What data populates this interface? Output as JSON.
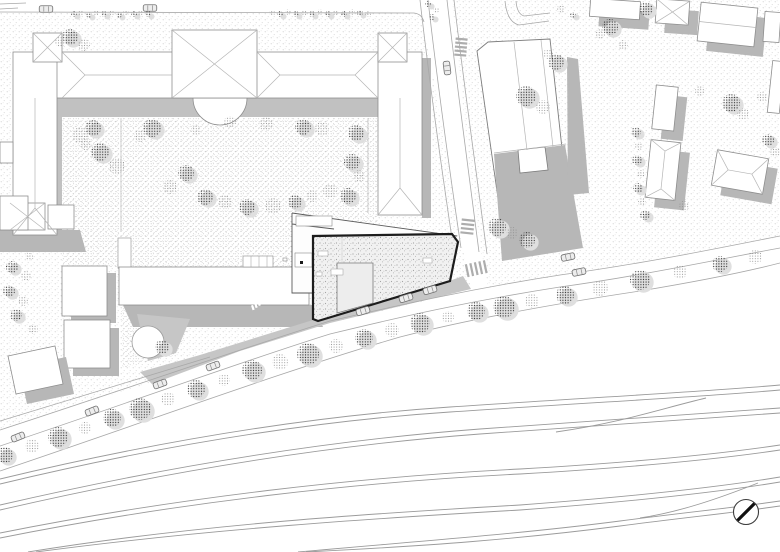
{
  "colors": {
    "background": "#ffffff",
    "outline": "#8e8e8e",
    "ridge": "#b5b5b5",
    "shadow": "#b7b7b7",
    "terrace": "#c1c1c1",
    "sidewalk_band": "#c6c6c6",
    "street_line": "#a8a8a8",
    "rail_line": "#9b9b9b",
    "project_outline": "#1c1c1c",
    "annex_line": "#5a5a5a",
    "crosswalk": "#adadad",
    "tree_dark": "#2e2e2e",
    "tree_light": "#909090",
    "tree_halo": "#dfdfdf",
    "car_fill": "#ededed",
    "car_line": "#6f6f6f",
    "north_arrow": "#111111"
  },
  "ground": {
    "regions": [
      {
        "name": "upper-left-block",
        "pattern": "ground",
        "points": "0,13 414,13 422,18 432,70 444,140 456,210 463,250 471,288 430,300 330,323 240,351 150,383 60,410 0,430"
      },
      {
        "name": "right-block",
        "pattern": "ground",
        "points": "452,0 780,0 780,237 700,251 560,276 488,287 481,252 469,162 458,60"
      },
      {
        "name": "courtyard",
        "pattern": "ground2",
        "points": "62,117 378,117 378,226 293,214 293,268 131,268 131,238 118,238 118,268 62,268"
      },
      {
        "name": "plaza-triangle",
        "pattern": "ground2",
        "points": "121,308 192,319 177,355 122,368"
      }
    ]
  },
  "u_building": {
    "terrace": {
      "top_strip": [
        57,
        98,
        321,
        19
      ],
      "left_strip": [
        52,
        98,
        10,
        134
      ],
      "right_strip": [
        378,
        98,
        15,
        115
      ],
      "east_shadow": [
        422,
        58,
        9,
        160
      ],
      "south_shadow_points": "0,230 80,230 86,252 0,252",
      "apse_path": "M193,98 A27,27 0 0,0 247,98 Z"
    },
    "volumes": [
      {
        "name": "top-wing",
        "rect": [
          33,
          52,
          374,
          46
        ]
      },
      {
        "name": "left-wing",
        "rect": [
          13,
          52,
          44,
          183
        ]
      },
      {
        "name": "left-notch",
        "rect": [
          0,
          142,
          13,
          21
        ]
      },
      {
        "name": "right-wing",
        "rect": [
          378,
          52,
          44,
          163
        ]
      },
      {
        "name": "tower-left",
        "rect": [
          33,
          33,
          29,
          29
        ]
      },
      {
        "name": "tower-right",
        "rect": [
          378,
          33,
          29,
          29
        ]
      },
      {
        "name": "pavilion-center",
        "rect": [
          172,
          30,
          85,
          68
        ]
      },
      {
        "name": "pavilion-south",
        "rect": [
          10,
          203,
          35,
          27
        ]
      },
      {
        "name": "annex-south-a",
        "rect": [
          48,
          205,
          26,
          24
        ]
      },
      {
        "name": "annex-south-b",
        "rect": [
          0,
          196,
          28,
          34
        ]
      }
    ],
    "ridges": [
      "M85,75 L172,75",
      "M62,52 L85,75",
      "M62,98 L85,75",
      "M280,75 L355,75",
      "M257,52 L280,75",
      "M257,98 L280,75",
      "M378,52 L355,75",
      "M378,98 L355,75",
      "M35,98 L35,208",
      "M13,235 L35,208",
      "M57,235 L35,208",
      "M400,98 L400,188",
      "M378,215 L400,188",
      "M422,215 L400,188",
      "M33,33 L62,62",
      "M62,33 L33,62",
      "M378,33 L407,62",
      "M407,33 L378,62",
      "M172,30 L257,98",
      "M257,30 L172,98",
      "M10,203 L45,230",
      "M45,203 L10,230"
    ],
    "courtyard_paths": [
      "M121,118 L121,231",
      "M368,118 L368,213"
    ],
    "white_path_rect": [
      118,
      238,
      13,
      30
    ]
  },
  "left_cluster": {
    "b1_shadow": [
      71,
      273,
      45,
      50
    ],
    "b1": [
      62,
      266,
      45,
      50
    ],
    "b2_shadow": [
      73,
      328,
      46,
      48
    ],
    "b2": [
      64,
      320,
      46,
      48
    ],
    "bar_shadow_points": "123,305 313,305 323,327 133,327",
    "bar": [
      119,
      267,
      190,
      38
    ],
    "plaza_gray_points": "137,314 190,319 176,353 148,361",
    "plaza_circle": [
      148,
      342,
      16
    ],
    "corner_bldg_shadow_points": "19,367 66,357 74,394 27,404",
    "corner_bldg_points": "8,356 55,346 63,384 16,394"
  },
  "right_block": {
    "main": {
      "shadow_right_points": "567,57 578,59 589,193 568,195",
      "shadow_bottom_points": "494,154 565,145 583,248 502,261",
      "body_points": "477,51 488,42 550,39 567,194 498,198",
      "annex_points": "518,150 545,147 548,170 520,173",
      "lines": [
        "M494,153 L566,144",
        "M514,42 L527,150",
        "M541,40 L553,147"
      ]
    },
    "smalls": [
      {
        "x": 590,
        "y": 0,
        "w": 50,
        "h": 18,
        "rot": 4,
        "roof": "flat",
        "sh": true
      },
      {
        "x": 656,
        "y": 0,
        "w": 33,
        "h": 24,
        "rot": 4,
        "roof": "x",
        "sh": true
      },
      {
        "x": 699,
        "y": 5,
        "w": 57,
        "h": 39,
        "rot": 6,
        "roof": "gable-h",
        "sh": true
      },
      {
        "x": 764,
        "y": 12,
        "w": 16,
        "h": 30,
        "rot": 4,
        "roof": "flat",
        "sh": false
      },
      {
        "x": 654,
        "y": 86,
        "w": 22,
        "h": 44,
        "rot": 6,
        "roof": "flat",
        "sh": true
      },
      {
        "x": 770,
        "y": 61,
        "w": 12,
        "h": 52,
        "rot": 6,
        "roof": "flat",
        "sh": false
      },
      {
        "x": 648,
        "y": 141,
        "w": 30,
        "h": 58,
        "rot": 6,
        "roof": "hip-v",
        "sh": true
      },
      {
        "x": 714,
        "y": 154,
        "w": 52,
        "h": 36,
        "rot": 10,
        "roof": "hip-h",
        "sh": true
      }
    ],
    "shadow_offset": [
      9,
      10
    ]
  },
  "streets": {
    "lines": [
      "M0,430 C120,391 240,349 330,321 C400,305 470,289 560,275 C640,264 710,250 780,236",
      "M0,446 C120,406 240,362 330,334 C400,317 470,301 560,287 C640,276 710,261 780,248",
      "M0,471 C140,424 280,372 400,337 C470,319 560,303 640,291 C700,281 745,272 780,263",
      "M0,421 C80,396 160,372 210,357",
      "M428,0 C436,70 448,160 461,248",
      "M447,0 C455,70 467,160 479,252",
      "M420,0 C428,70 441,165 454,252",
      "M454,0 C462,70 475,162 487,254",
      "M0,12 L414,13 Q422,14 424,22",
      "M505,1 Q507,22 519,25 L549,21",
      "M516,1 Q517,14 524,16 L550,13",
      "M0,4 L26,3",
      "M0,9 L18,8"
    ],
    "sidewalk_band_points": "140,372 200,355 313,320 452,280 463,276 471,289 430,299 330,323 240,351 152,384",
    "crosswalks": [
      {
        "cx": 461,
        "cy": 46,
        "rot": 5,
        "horiz": true,
        "n": 5,
        "x": 455,
        "y": 38,
        "w": 12,
        "h": 2.2,
        "step": 4
      },
      {
        "cx": 467,
        "cy": 227,
        "rot": 6,
        "horiz": true,
        "n": 4,
        "x": 461,
        "y": 219,
        "w": 13,
        "h": 2.2,
        "step": 4.3
      },
      {
        "cx": 477,
        "cy": 269,
        "rot": -12,
        "horiz": false,
        "n": 5,
        "x": 466,
        "y": 262,
        "w": 2.2,
        "h": 13,
        "step": 4.6
      }
    ],
    "dashes": {
      "x0": 251,
      "y0": 305.5,
      "dx": 3.6,
      "dy": -1.1,
      "n": 8,
      "w": 2.2,
      "h": 5,
      "rot": -18
    }
  },
  "railway": {
    "tracks": [
      "M0,479 C150,443 300,417 450,407 C600,397 700,392 780,385",
      "M0,484 C150,448 300,422 450,412 C600,402 700,397 780,390",
      "M0,505 C160,468 320,441 480,429 C620,419 720,412 780,408",
      "M0,510 C160,473 320,446 480,434 C620,424 720,417 780,413",
      "M556,432 C620,423 660,409 706,398",
      "M0,533 C180,497 360,477 520,469 C640,462 720,454 780,445",
      "M0,538 C180,502 360,482 520,474 C640,467 720,459 780,450",
      "M28,552 C200,524 380,513 520,505 C640,496 720,487 780,477",
      "M36,552 C208,529 380,518 520,510 C640,501 720,492 780,482",
      "M298,552 C420,541 520,534 620,521 C680,513 740,507 780,501",
      "M306,552 C428,546 520,539 620,526 C680,518 740,512 780,506",
      "M640,518 C680,512 720,498 758,483"
    ]
  },
  "annex": {
    "body_points": "292,213 457,236 455,238 313,238 313,293 292,293",
    "outline_paths": [
      "M292,213 L457,236",
      "M292,213 L292,293 L313,293",
      "M292,224 L334,229",
      "M295,253 L312,267"
    ],
    "rooms": [
      [
        296,
        216,
        36,
        10
      ],
      [
        295,
        253,
        17,
        14
      ],
      [
        243,
        256,
        30,
        11
      ],
      [
        283,
        258,
        4,
        3
      ]
    ],
    "room_lines": [
      "M251,256 L251,267",
      "M259,256 L259,267",
      "M267,256 L267,267"
    ],
    "black_square": [
      300,
      261,
      3,
      3
    ]
  },
  "project_building": {
    "body_points": "313,236 452,234 458,242 450,281 318,321 313,319",
    "inner_points": "337,263 373,263 373,303 337,313",
    "roof_whites": [
      [
        318,
        251,
        10,
        5
      ],
      [
        331,
        269,
        12,
        6
      ],
      [
        423,
        258,
        9,
        5
      ],
      [
        316,
        272,
        6,
        4
      ]
    ],
    "roof_line": "M342,238 L342,262"
  },
  "trees": {
    "street_row": [
      [
        5,
        455,
        8,
        0
      ],
      [
        32,
        446,
        7,
        1
      ],
      [
        58,
        437,
        10,
        0
      ],
      [
        85,
        428,
        6,
        1
      ],
      [
        112,
        418,
        9,
        0
      ],
      [
        140,
        409,
        11,
        0
      ],
      [
        168,
        399,
        7,
        1
      ],
      [
        196,
        389,
        9,
        0
      ],
      [
        224,
        380,
        6,
        1
      ],
      [
        252,
        370,
        10,
        0
      ],
      [
        280,
        362,
        8,
        1
      ],
      [
        308,
        354,
        11,
        0
      ],
      [
        336,
        346,
        7,
        1
      ],
      [
        364,
        338,
        9,
        0
      ],
      [
        392,
        330,
        7,
        1
      ],
      [
        420,
        323,
        10,
        0
      ],
      [
        448,
        317,
        6,
        1
      ],
      [
        476,
        311,
        9,
        0
      ],
      [
        504,
        307,
        11,
        0
      ],
      [
        532,
        301,
        7,
        1
      ],
      [
        565,
        295,
        9,
        0
      ],
      [
        600,
        288,
        8,
        1
      ],
      [
        640,
        280,
        10,
        0
      ],
      [
        680,
        272,
        7,
        1
      ],
      [
        720,
        264,
        8,
        0
      ],
      [
        755,
        257,
        7,
        1
      ]
    ],
    "courtyard": [
      [
        80,
        135,
        8,
        1
      ],
      [
        93,
        128,
        8,
        0
      ],
      [
        152,
        128,
        9,
        0
      ],
      [
        140,
        136,
        6,
        1
      ],
      [
        196,
        130,
        5,
        1
      ],
      [
        230,
        122,
        6,
        1
      ],
      [
        266,
        124,
        7,
        1
      ],
      [
        303,
        127,
        8,
        0
      ],
      [
        322,
        129,
        7,
        1
      ],
      [
        356,
        133,
        8,
        0
      ],
      [
        352,
        162,
        8,
        0
      ],
      [
        359,
        176,
        6,
        1
      ],
      [
        348,
        196,
        8,
        0
      ],
      [
        330,
        191,
        7,
        1
      ],
      [
        312,
        196,
        6,
        1
      ],
      [
        295,
        202,
        7,
        0
      ],
      [
        273,
        206,
        8,
        1
      ],
      [
        247,
        207,
        8,
        0
      ],
      [
        225,
        202,
        7,
        1
      ],
      [
        205,
        197,
        8,
        0
      ],
      [
        186,
        173,
        8,
        0
      ],
      [
        170,
        187,
        7,
        1
      ],
      [
        100,
        152,
        9,
        0
      ],
      [
        117,
        166,
        8,
        1
      ],
      [
        86,
        144,
        6,
        1
      ],
      [
        162,
        347,
        7,
        0
      ]
    ],
    "scatter_right": [
      [
        526,
        96,
        10,
        0
      ],
      [
        543,
        107,
        7,
        1
      ],
      [
        556,
        62,
        8,
        0
      ],
      [
        548,
        54,
        5,
        1
      ],
      [
        610,
        27,
        8,
        0
      ],
      [
        600,
        34,
        5,
        1
      ],
      [
        646,
        9,
        7,
        0
      ],
      [
        623,
        45,
        5,
        1
      ],
      [
        731,
        103,
        9,
        0
      ],
      [
        743,
        114,
        6,
        1
      ],
      [
        762,
        97,
        5,
        1
      ],
      [
        497,
        227,
        9,
        0
      ],
      [
        527,
        240,
        8,
        0
      ],
      [
        512,
        233,
        6,
        1
      ],
      [
        768,
        140,
        6,
        0
      ],
      [
        775,
        152,
        5,
        1
      ],
      [
        700,
        91,
        5,
        1
      ],
      [
        636,
        132,
        5,
        0
      ],
      [
        639,
        146,
        4,
        1
      ],
      [
        637,
        160,
        5,
        0
      ],
      [
        641,
        174,
        4,
        1
      ],
      [
        638,
        188,
        5,
        0
      ],
      [
        642,
        202,
        4,
        1
      ],
      [
        645,
        215,
        5,
        0
      ],
      [
        684,
        206,
        5,
        1
      ],
      [
        561,
        9,
        4,
        1
      ],
      [
        573,
        15,
        3,
        0
      ],
      [
        428,
        4,
        3,
        0
      ],
      [
        436,
        10,
        3,
        1
      ],
      [
        432,
        17,
        3,
        0
      ]
    ],
    "scatter_left": [
      [
        12,
        267,
        6,
        0
      ],
      [
        26,
        276,
        5,
        1
      ],
      [
        9,
        291,
        6,
        0
      ],
      [
        23,
        301,
        5,
        1
      ],
      [
        16,
        315,
        6,
        0
      ],
      [
        33,
        329,
        5,
        1
      ],
      [
        29,
        257,
        4,
        1
      ],
      [
        70,
        37,
        8,
        0
      ],
      [
        84,
        45,
        6,
        1
      ],
      [
        60,
        42,
        5,
        1
      ]
    ],
    "bushes_top": [
      [
        74,
        14
      ],
      [
        81,
        13
      ],
      [
        89,
        15
      ],
      [
        96,
        13
      ],
      [
        104,
        14
      ],
      [
        111,
        13
      ],
      [
        119,
        15
      ],
      [
        126,
        13
      ],
      [
        134,
        14
      ],
      [
        141,
        13
      ],
      [
        148,
        14
      ],
      [
        272,
        13
      ],
      [
        280,
        14
      ],
      [
        288,
        12
      ],
      [
        296,
        14
      ],
      [
        304,
        13
      ],
      [
        312,
        14
      ],
      [
        320,
        12
      ],
      [
        328,
        14
      ],
      [
        336,
        13
      ],
      [
        344,
        14
      ],
      [
        352,
        12
      ],
      [
        360,
        13
      ],
      [
        368,
        14
      ]
    ]
  },
  "cars": [
    [
      46,
      9,
      0
    ],
    [
      150,
      8,
      0
    ],
    [
      447,
      68,
      83
    ],
    [
      568,
      257,
      -12
    ],
    [
      579,
      272,
      -12
    ],
    [
      363,
      311,
      -17
    ],
    [
      406,
      298,
      -17
    ],
    [
      430,
      290,
      -17
    ],
    [
      18,
      437,
      -22
    ],
    [
      92,
      411,
      -22
    ],
    [
      160,
      384,
      -20
    ],
    [
      213,
      366,
      -20
    ]
  ],
  "north_arrow": {
    "cx": 746,
    "cy": 512,
    "r": 12.5,
    "x1": 737.5,
    "y1": 520.5,
    "x2": 754.5,
    "y2": 503.5
  }
}
